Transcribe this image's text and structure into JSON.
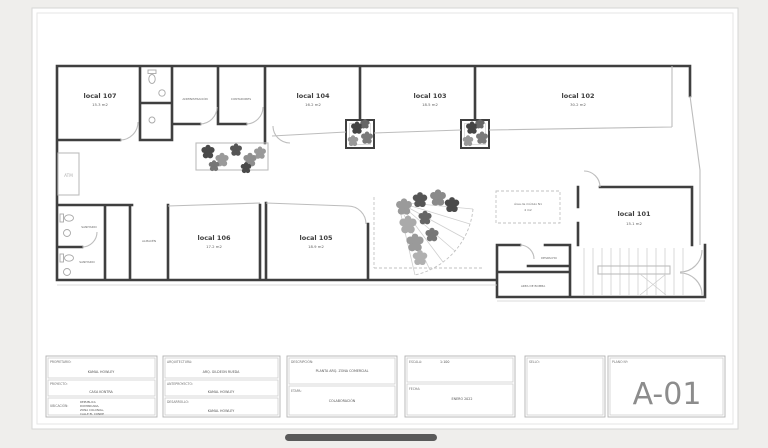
{
  "colors": {
    "background": "#efeeec",
    "sheet": "#ffffff",
    "wall": "#3f3f3f",
    "light_line": "#bdbdbd",
    "plant_dark": "#4a4a4a",
    "plant_mid": "#8a8a8a",
    "plano_text": "#8c8c8c",
    "scrollbar": "#5a5a5a"
  },
  "plan": {
    "local107": {
      "name": "local 107",
      "area": "15.3 m2"
    },
    "local104": {
      "name": "local 104",
      "area": "16.2 m2"
    },
    "local103": {
      "name": "local 103",
      "area": "18.5 m2"
    },
    "local102": {
      "name": "local 102",
      "area": "30.2 m2"
    },
    "local101": {
      "name": "local 101",
      "area": "15.1 m2"
    },
    "local106": {
      "name": "local 106",
      "area": "17.2 m2"
    },
    "local105": {
      "name": "local 105",
      "area": "18.9 m2"
    },
    "administracion": "ADMINISTRACIÓN",
    "contadores": "CONTADORES",
    "sanitario_1": "SANITARIO",
    "sanitario_2": "SANITARIO",
    "almacen": "ALMACÉN",
    "atm": "ATM",
    "despacho": "DESPACHO",
    "area_bomba": "AREA DE BOMBA",
    "modulo_line1": "Área de módulo N1",
    "modulo_line2": "4 m2"
  },
  "titleblock": {
    "propietario_label": "PROPIETARIO:",
    "propietario_value": "KAMAL HOWLEY",
    "proyecto_label": "PROYECTO:",
    "proyecto_value": "CASA KONTRA",
    "ubicacion_label": "UBICACIÓN:",
    "ubicacion_l1": "REPUBLICA",
    "ubicacion_l2": "DOMINICANA,",
    "ubicacion_l3": "ZONA COLONIAL,",
    "ubicacion_l4": "CALLE EL CONDE",
    "arquitectura_label": "ARQUITECTURA:",
    "arquitectura_value": "ARQ. GILDEON RUEDA",
    "anteproyecto_label": "ANTEPROYECTO:",
    "anteproyecto_value": "KAMAL HOWLEY",
    "desarrollo_label": "DESARROLLO:",
    "desarrollo_value": "KAMAL HOWLEY",
    "descripcion_label": "DESCRIPCIÓN:",
    "descripcion_value": "PLANTA ARQ. ZONA COMERCIAL",
    "etapa_label": "ETAPA:",
    "etapa_value": "COLABORACIÓN",
    "escala_label": "ESCALA:",
    "escala_value": "1:100",
    "fecha_label": "FECHA:",
    "fecha_value": "ENERO 2022",
    "sello_label": "SELLO:",
    "plano_label": "PLANO Nº:",
    "plano_value": "A-01"
  }
}
